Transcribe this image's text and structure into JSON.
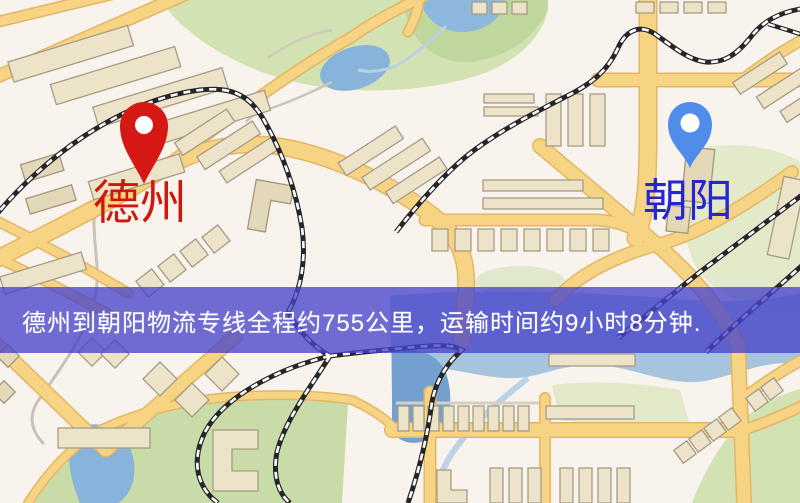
{
  "map": {
    "origin_pin": {
      "label": "德州",
      "pin_color": "#e01410",
      "label_color": "#d81408"
    },
    "destination_pin": {
      "label": "朝阳",
      "pin_color": "#4a8cf0",
      "label_color": "#2424dd"
    },
    "banner": {
      "text": "德州到朝阳物流专线全程约755公里，运输时间约9小时8分钟.",
      "background": "#4844ca",
      "text_color": "#ffffff"
    },
    "palette": {
      "map_background": "#f7f1ea",
      "road_yellow": "#f6d27c",
      "road_edge": "#e5b45c",
      "building_tan": "#eae1c4",
      "park_green": "#cfe0ad",
      "water_blue": "#84b2dc",
      "railway_black": "#26262a"
    }
  }
}
